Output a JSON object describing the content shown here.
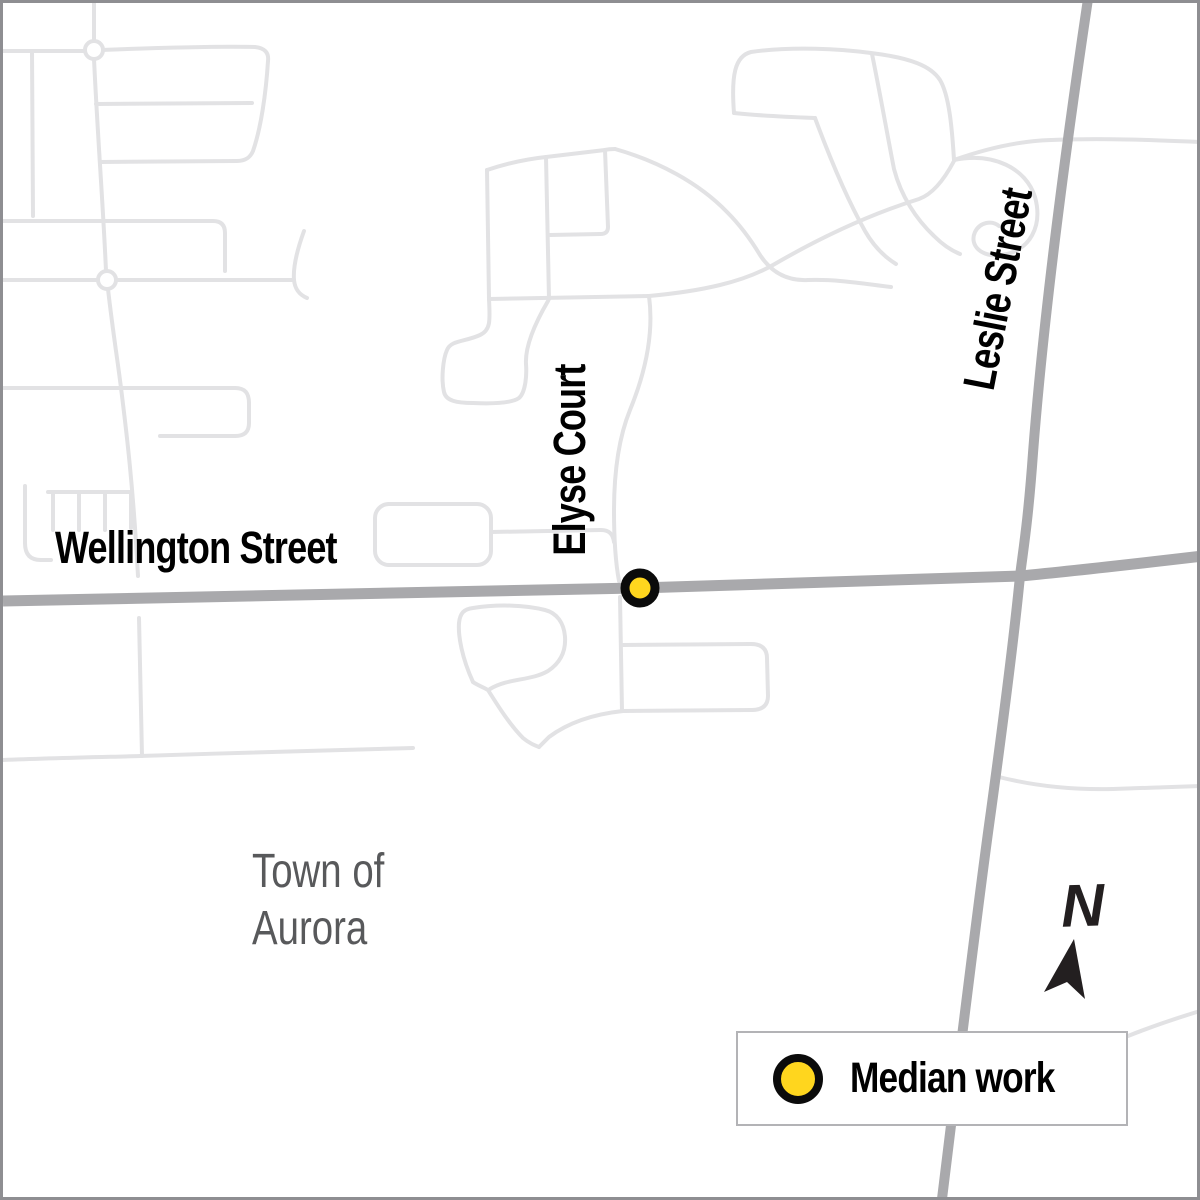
{
  "map": {
    "street_labels": {
      "wellington": "Wellington Street",
      "elyse": "Elyse Court",
      "leslie": "Leslie Street"
    },
    "region": {
      "line1": "Town of",
      "line2": "Aurora"
    },
    "marker": {
      "x": 637,
      "y": 585,
      "r": 15
    }
  },
  "legend": {
    "item_label": "Median work"
  },
  "north": {
    "label": "N"
  },
  "colors": {
    "marker_fill": "#FFD61E",
    "marker_stroke": "#0b0b0b",
    "major_road": "#a9a9ac",
    "minor_road": "#e2e2e4",
    "frame": "#8e8e92",
    "region_text": "#58595b",
    "label_text": "#000000",
    "legend_border": "#b3b3b6",
    "legend_bg": "#ffffff",
    "north_arrow": "#231f20"
  }
}
